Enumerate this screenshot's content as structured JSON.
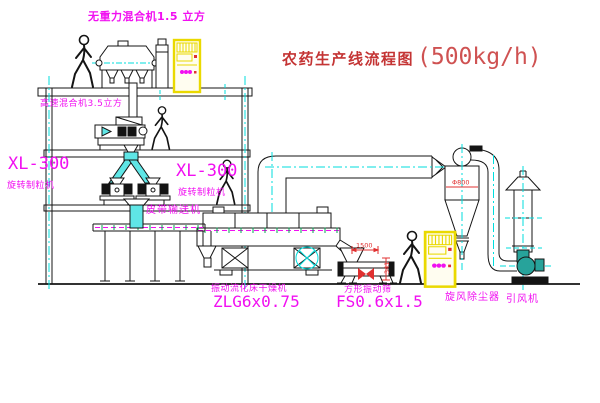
{
  "title": {
    "cn": "农药生产线流程图",
    "capacity": "(500kg/h)"
  },
  "labels": {
    "gravity_free_mixer": "无重力混合机1.5 立方",
    "high_speed_mixer": "高速混合机3.5立方",
    "xl300_left": "XL-300",
    "granulator_left": "旋转制粒机",
    "xl300_right": "XL-300",
    "granulator_right": "旋转制粒机",
    "belt_conveyor": "皮带输送机",
    "dryer_name": "振动流化床干燥机",
    "dryer_model": "ZLG6x0.75",
    "sieve_name": "方形振动筛",
    "sieve_model": "FS0.6x1.5",
    "cyclone": "旋风除尘器",
    "fan": "引风机"
  },
  "dimensions": {
    "cyclone_diameter": "Φ800",
    "sieve_length": "1500",
    "sieve_height": "341"
  },
  "colors": {
    "line": "#141414",
    "centerline_cyan": "#00dede",
    "label_magenta": "#f10ff1",
    "title_red": "#c43434",
    "cabinet_yellow": "#ead900",
    "fan_teal": "#27a39b",
    "tick_green": "#00a650",
    "dimension_red": "#e03030"
  }
}
